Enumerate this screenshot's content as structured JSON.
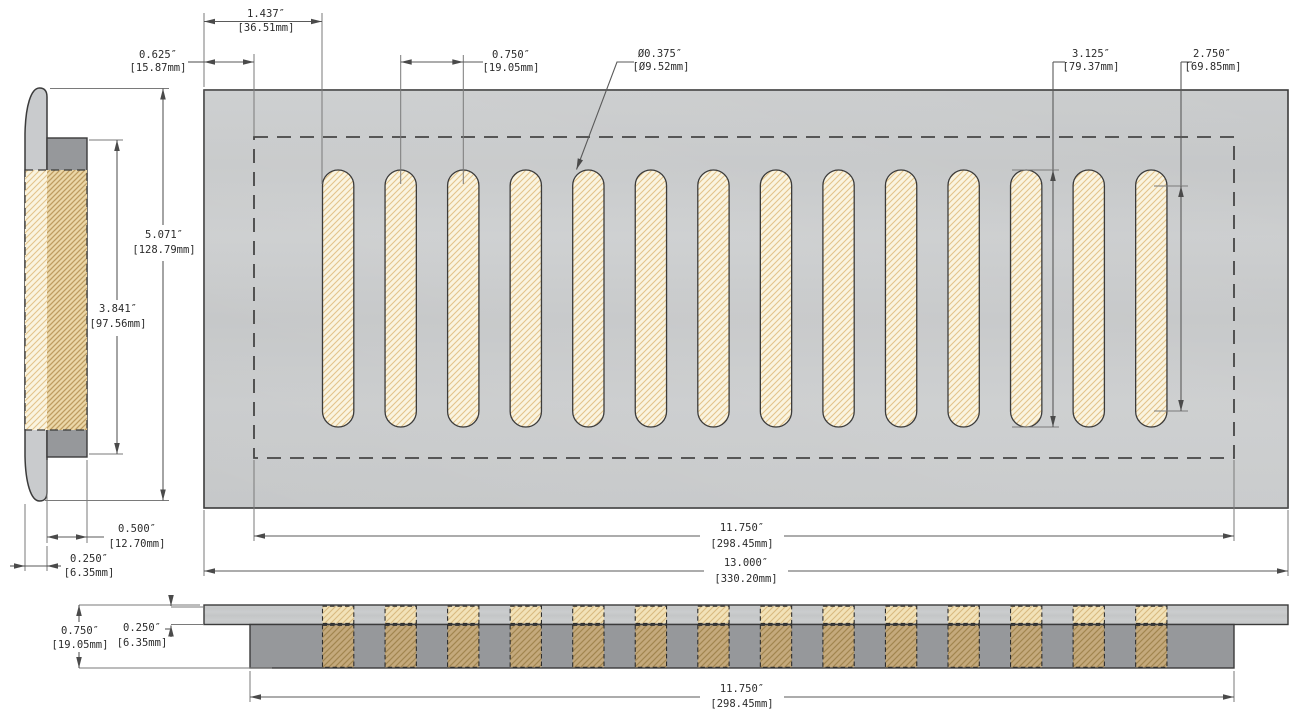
{
  "geometry": {
    "slot_count": 14
  },
  "colors": {
    "background": "#FFFFFF",
    "plate_gray": "#C8CACB",
    "flange_gray": "#96989B",
    "slot_cream": "#FAF4E0",
    "hatch_tan": "#E3C48C",
    "hatch_dark_tan": "#C4A97C",
    "outline": "#3B3B3B",
    "dimension_lines": "#5A5A5A"
  },
  "dims": {
    "first_slot_offset": {
      "in": "1.437″",
      "mm": "[36.51mm]"
    },
    "border_offset": {
      "in": "0.625″",
      "mm": "[15.87mm]"
    },
    "slot_pitch": {
      "in": "0.750″",
      "mm": "[19.05mm]"
    },
    "slot_width_dia": {
      "in": "Ø0.375″",
      "mm": "[Ø9.52mm]"
    },
    "slot_length": {
      "in": "3.125″",
      "mm": "[79.37mm]"
    },
    "slot_straight_length": {
      "in": "2.750″",
      "mm": "[69.85mm]"
    },
    "faceplate_height": {
      "in": "5.071″",
      "mm": "[128.79mm]"
    },
    "opening_height": {
      "in": "3.841″",
      "mm": "[97.56mm]"
    },
    "flange_depth": {
      "in": "0.500″",
      "mm": "[12.70mm]"
    },
    "faceplate_thickness": {
      "in": "0.250″",
      "mm": "[6.35mm]"
    },
    "opening_width": {
      "in": "11.750″",
      "mm": "[298.45mm]"
    },
    "overall_width": {
      "in": "13.000″",
      "mm": "[330.20mm]"
    },
    "overall_depth": {
      "in": "0.750″",
      "mm": "[19.05mm]"
    },
    "plate_thickness_front": {
      "in": "0.250″",
      "mm": "[6.35mm]"
    },
    "opening_width_front": {
      "in": "11.750″",
      "mm": "[298.45mm]"
    }
  }
}
